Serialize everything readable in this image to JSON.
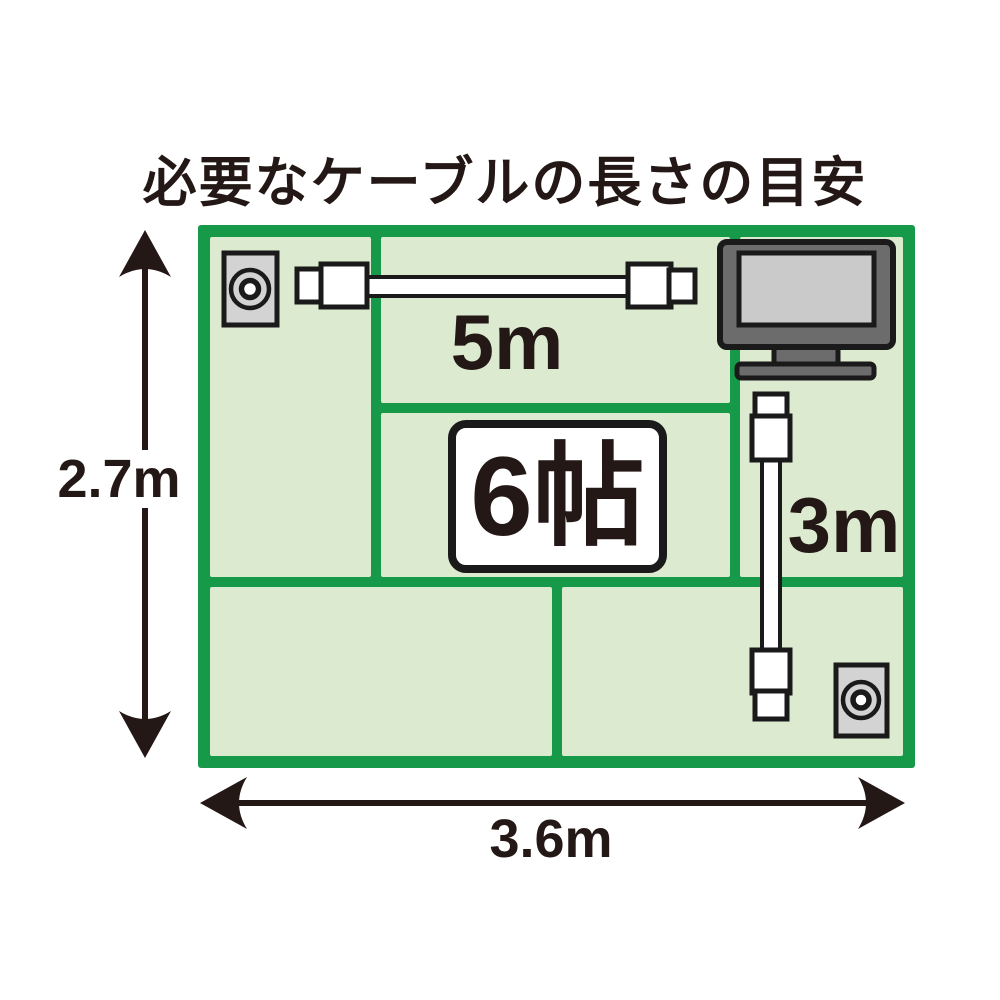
{
  "title": "必要なケーブルの長さの目安",
  "room": {
    "size_label": "6帖",
    "tatami_count": 6
  },
  "dimensions": {
    "height": "2.7m",
    "width": "3.6m"
  },
  "cables": {
    "horizontal": "5m",
    "vertical": "3m"
  },
  "icons": {
    "top_left": "antenna-outlet-icon",
    "bottom_right": "antenna-outlet-icon",
    "top_right": "tv-icon",
    "connectors": "coax-cable-icon"
  },
  "colors": {
    "room_border_green": "#169a4a",
    "tatami_fill_green": "#dcead0",
    "text_black": "#231815",
    "tv_body_gray": "#6c6c6c",
    "tv_screen_gray": "#cacaca",
    "outlet_gray": "#d3d3d3",
    "cable_white": "#ffffff"
  }
}
